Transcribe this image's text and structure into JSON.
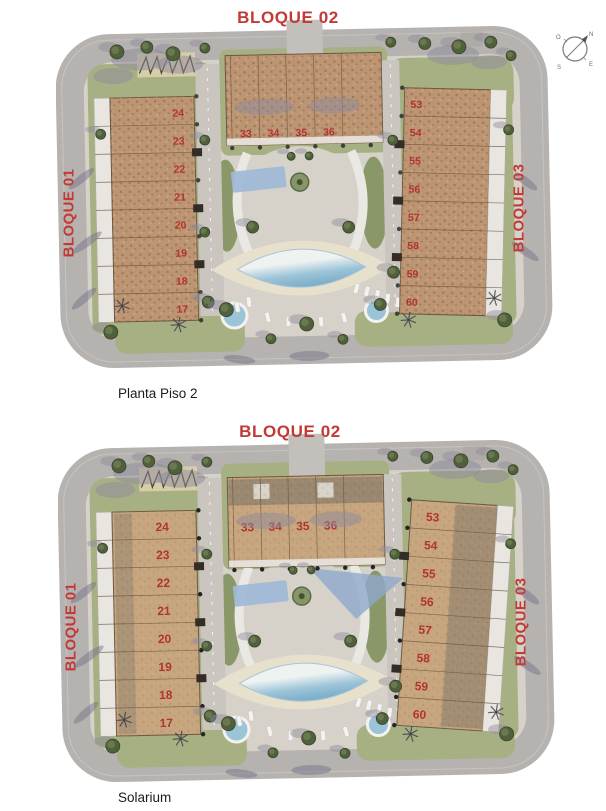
{
  "compass": {
    "n": "N",
    "o": "O",
    "e": "E",
    "s": "S"
  },
  "colors": {
    "accent_red": "#c23a35",
    "number_red": "#b23330",
    "road_gray": "#b6b2af",
    "paving": "#d6d2ca",
    "path": "#cac6bf",
    "green": "#a7b083",
    "green_dark": "#8a9768",
    "balcony": "#e9e6e1",
    "building_tan_piso": "#bd9572",
    "building_tan_solarium": "#c7a67f",
    "roof_dark": "#9a8871",
    "pool_blue": "#9cc4d8",
    "pool_white": "#eef2f1",
    "deck_cream": "#e7e0cd",
    "shadow_gray": "#8d899b"
  },
  "plans": [
    {
      "id": "planta-piso-2",
      "caption": "Planta Piso 2",
      "blocks": {
        "bloque01": {
          "label": "BLOQUE 01",
          "units": [
            "24",
            "23",
            "22",
            "21",
            "20",
            "19",
            "18",
            "17"
          ]
        },
        "bloque02": {
          "label": "BLOQUE 02",
          "units": [
            "33",
            "34",
            "35",
            "36"
          ]
        },
        "bloque03": {
          "label": "BLOQUE 03",
          "units": [
            "53",
            "54",
            "55",
            "56",
            "57",
            "58",
            "59",
            "60"
          ]
        }
      }
    },
    {
      "id": "solarium",
      "caption": "Solarium",
      "blocks": {
        "bloque01": {
          "label": "BLOQUE 01",
          "units": [
            "24",
            "23",
            "22",
            "21",
            "20",
            "19",
            "18",
            "17"
          ]
        },
        "bloque02": {
          "label": "BLOQUE 02",
          "units": [
            "33",
            "34",
            "35",
            "36"
          ]
        },
        "bloque03": {
          "label": "BLOQUE 03",
          "units": [
            "53",
            "54",
            "55",
            "56",
            "57",
            "58",
            "59",
            "60"
          ]
        }
      }
    }
  ]
}
